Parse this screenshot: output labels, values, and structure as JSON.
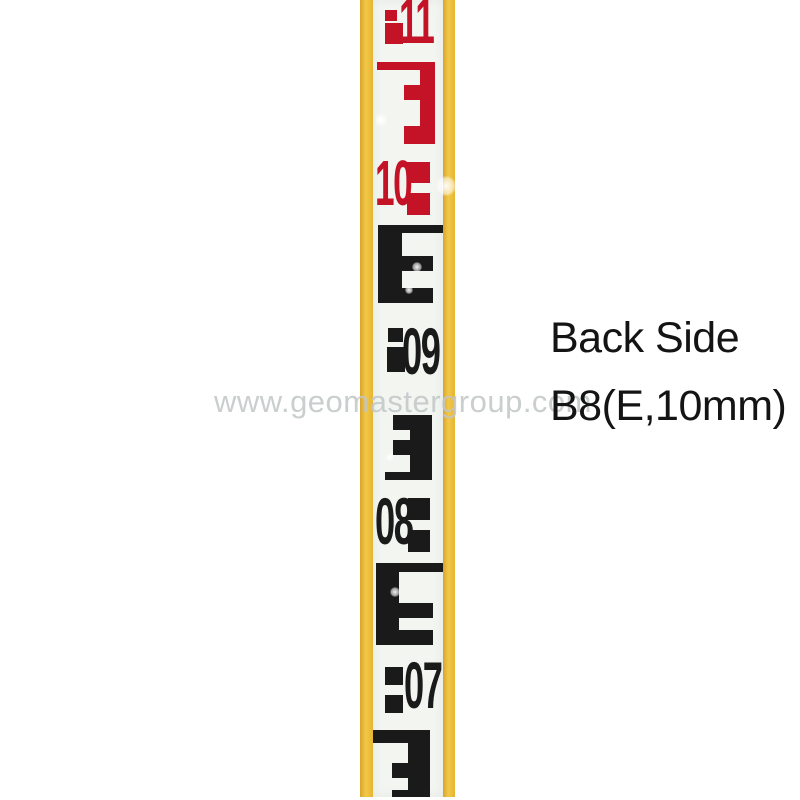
{
  "image": {
    "subject": "surveying-leveling-staff-photo",
    "width_px": 800,
    "height_px": 800
  },
  "annotation": {
    "line1": "Back Side",
    "line2": "B8(E,10mm)"
  },
  "watermark": {
    "text": "www.geomastergroup.com"
  },
  "palette": {
    "page_bg": "#FFFFFF",
    "yellow": "#EFC23B",
    "staff_white": "#F2F5F0",
    "red": "#C41226",
    "black": "#1A1A1A",
    "annotation_text": "#141414",
    "watermark_gray": "#C1C5C7"
  },
  "rod": {
    "graduation_type": "E-pattern, 10mm units",
    "readings_top_to_bottom": [
      {
        "label": "11",
        "color": "red"
      },
      {
        "label": "10",
        "color": "red"
      },
      {
        "label": "09",
        "color": "black"
      },
      {
        "label": "08",
        "color": "black"
      },
      {
        "label": "07",
        "color": "black"
      }
    ],
    "numbers": [
      {
        "text": "11",
        "color": "red",
        "left": 399,
        "top": -11,
        "size": 64
      },
      {
        "text": "10",
        "color": "red",
        "left": 375,
        "top": 151,
        "size": 64
      },
      {
        "text": "09",
        "color": "black",
        "left": 402,
        "top": 318,
        "size": 66
      },
      {
        "text": "08",
        "color": "black",
        "left": 375,
        "top": 488,
        "size": 66
      },
      {
        "text": "07",
        "color": "black",
        "left": 404,
        "top": 652,
        "size": 66
      }
    ],
    "rects": [
      {
        "name": "block-11-small",
        "x": 385,
        "y": 10,
        "w": 12,
        "h": 11,
        "color": "red"
      },
      {
        "name": "block-11-large",
        "x": 385,
        "y": 23,
        "w": 18,
        "h": 21,
        "color": "red"
      },
      {
        "name": "e-red-top-bar",
        "x": 377,
        "y": 62,
        "w": 58,
        "h": 8,
        "color": "red"
      },
      {
        "name": "e-red-stem",
        "x": 420,
        "y": 62,
        "w": 15,
        "h": 82,
        "color": "red"
      },
      {
        "name": "e-red-mid-arm",
        "x": 404,
        "y": 85,
        "w": 16,
        "h": 15,
        "color": "red"
      },
      {
        "name": "e-red-bottom-arm",
        "x": 404,
        "y": 126,
        "w": 16,
        "h": 18,
        "color": "red"
      },
      {
        "name": "block-10-top",
        "x": 407,
        "y": 162,
        "w": 23,
        "h": 21,
        "color": "red"
      },
      {
        "name": "block-10-bottom",
        "x": 407,
        "y": 193,
        "w": 23,
        "h": 22,
        "color": "red"
      },
      {
        "name": "e-black1-top-bar",
        "x": 378,
        "y": 225,
        "w": 65,
        "h": 8,
        "color": "black"
      },
      {
        "name": "e-black1-stem",
        "x": 378,
        "y": 225,
        "w": 24,
        "h": 78,
        "color": "black"
      },
      {
        "name": "e-black1-mid-arm",
        "x": 402,
        "y": 256,
        "w": 31,
        "h": 15,
        "color": "black"
      },
      {
        "name": "e-black1-bottom-arm",
        "x": 402,
        "y": 288,
        "w": 31,
        "h": 15,
        "color": "black"
      },
      {
        "name": "block-09-top",
        "x": 388,
        "y": 328,
        "w": 15,
        "h": 14,
        "color": "black"
      },
      {
        "name": "block-09-bottom",
        "x": 387,
        "y": 347,
        "w": 18,
        "h": 25,
        "color": "black"
      },
      {
        "name": "e-black2-top-arm",
        "x": 393,
        "y": 415,
        "w": 17,
        "h": 15,
        "color": "black"
      },
      {
        "name": "e-black2-mid-arm",
        "x": 393,
        "y": 440,
        "w": 17,
        "h": 15,
        "color": "black"
      },
      {
        "name": "e-black2-stem",
        "x": 410,
        "y": 415,
        "w": 22,
        "h": 65,
        "color": "black"
      },
      {
        "name": "e-black2-bottom-bar",
        "x": 385,
        "y": 472,
        "w": 47,
        "h": 8,
        "color": "black"
      },
      {
        "name": "block-08-top",
        "x": 408,
        "y": 498,
        "w": 22,
        "h": 22,
        "color": "black"
      },
      {
        "name": "block-08-bottom",
        "x": 408,
        "y": 530,
        "w": 22,
        "h": 22,
        "color": "black"
      },
      {
        "name": "e-black3-top-bar",
        "x": 376,
        "y": 563,
        "w": 67,
        "h": 9,
        "color": "black"
      },
      {
        "name": "e-black3-stem",
        "x": 376,
        "y": 563,
        "w": 23,
        "h": 82,
        "color": "black"
      },
      {
        "name": "e-black3-mid-arm",
        "x": 399,
        "y": 603,
        "w": 34,
        "h": 15,
        "color": "black"
      },
      {
        "name": "e-black3-bottom-arm",
        "x": 399,
        "y": 630,
        "w": 34,
        "h": 15,
        "color": "black"
      },
      {
        "name": "block-07-top",
        "x": 385,
        "y": 667,
        "w": 18,
        "h": 18,
        "color": "black"
      },
      {
        "name": "block-07-bottom",
        "x": 385,
        "y": 695,
        "w": 18,
        "h": 18,
        "color": "black"
      },
      {
        "name": "e-black4-top-bar",
        "x": 373,
        "y": 730,
        "w": 57,
        "h": 13,
        "color": "black"
      },
      {
        "name": "e-black4-stem",
        "x": 408,
        "y": 730,
        "w": 22,
        "h": 67,
        "color": "black"
      },
      {
        "name": "e-black4-mid-arm",
        "x": 392,
        "y": 763,
        "w": 16,
        "h": 15,
        "color": "black"
      },
      {
        "name": "e-black4-bottom-arm",
        "x": 392,
        "y": 790,
        "w": 38,
        "h": 7,
        "color": "black"
      }
    ],
    "flares": [
      {
        "x": 381,
        "y": 120,
        "r": 6
      },
      {
        "x": 446,
        "y": 186,
        "r": 10
      },
      {
        "x": 417,
        "y": 267,
        "r": 5
      },
      {
        "x": 409,
        "y": 290,
        "r": 4
      },
      {
        "x": 390,
        "y": 457,
        "r": 4
      },
      {
        "x": 395,
        "y": 592,
        "r": 5
      }
    ]
  }
}
